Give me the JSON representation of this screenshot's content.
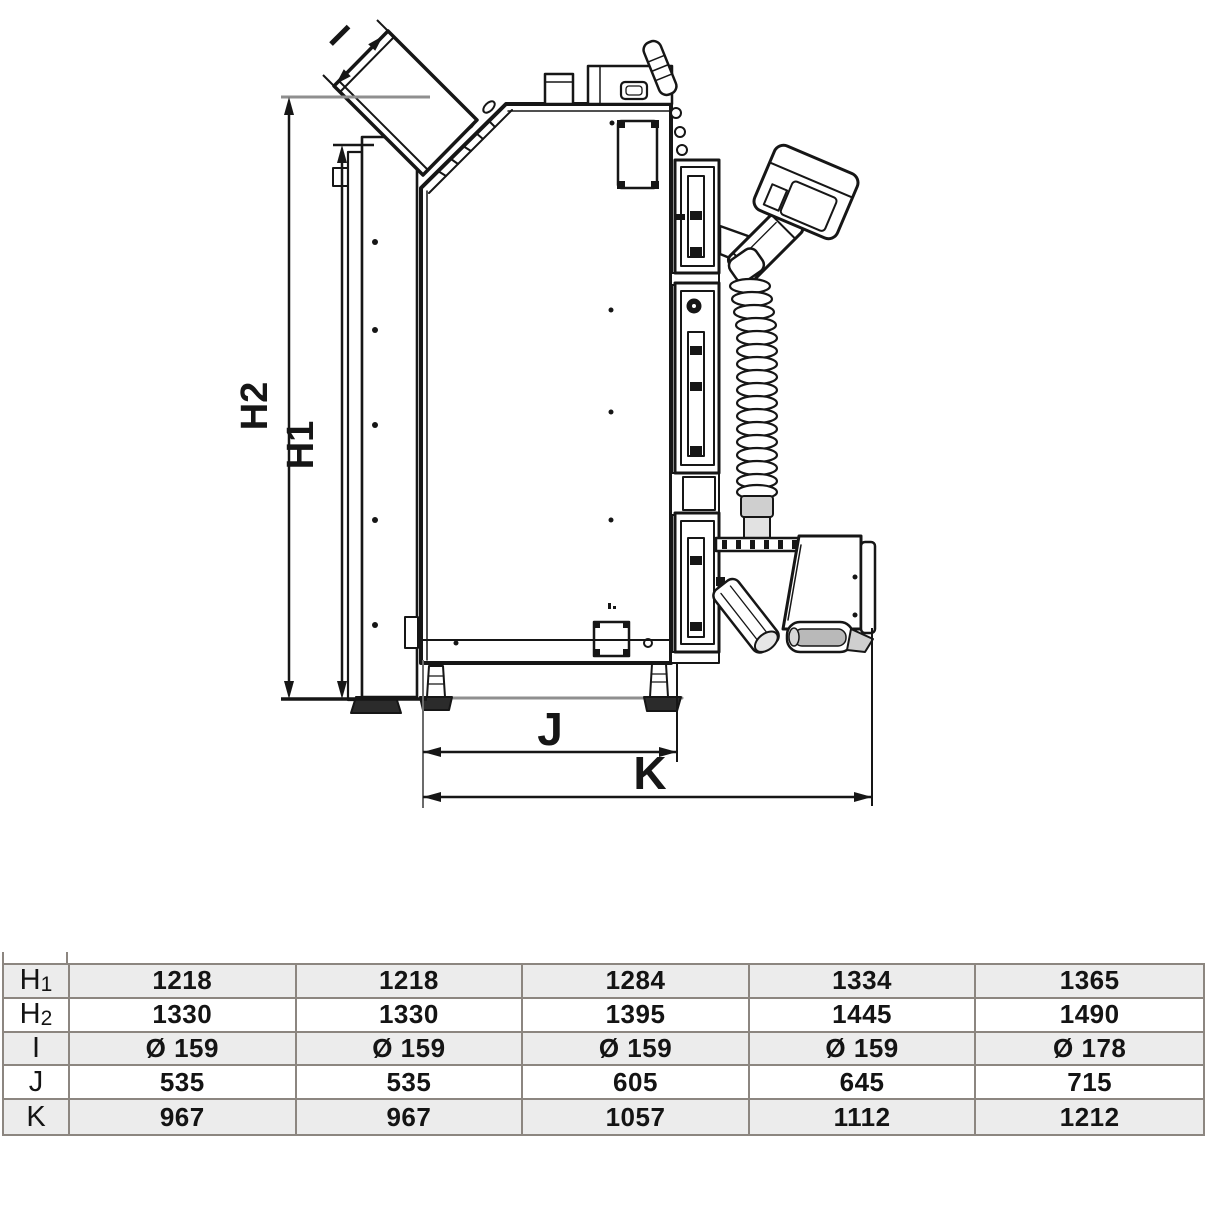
{
  "diagram": {
    "labels": {
      "h1": "H1",
      "h2": "H2",
      "i": "I",
      "j": "J",
      "k": "K"
    }
  },
  "table": {
    "rows": [
      {
        "label_main": "H",
        "label_sub": "1",
        "shaded": true,
        "values": [
          "1218",
          "1218",
          "1284",
          "1334",
          "1365"
        ]
      },
      {
        "label_main": "H",
        "label_sub": "2",
        "shaded": false,
        "values": [
          "1330",
          "1330",
          "1395",
          "1445",
          "1490"
        ]
      },
      {
        "label_main": "I",
        "label_sub": "",
        "shaded": true,
        "values": [
          "Ø 159",
          "Ø 159",
          "Ø 159",
          "Ø 159",
          "Ø 178"
        ]
      },
      {
        "label_main": "J",
        "label_sub": "",
        "shaded": false,
        "values": [
          "535",
          "535",
          "605",
          "645",
          "715"
        ]
      },
      {
        "label_main": "K",
        "label_sub": "",
        "shaded": true,
        "values": [
          "967",
          "967",
          "1057",
          "1112",
          "1212"
        ]
      }
    ]
  },
  "colors": {
    "line": "#161616",
    "extension_line": "#8f8f8f",
    "table_border": "#8c8680",
    "row_shade": "#ececec",
    "text": "#141414"
  }
}
